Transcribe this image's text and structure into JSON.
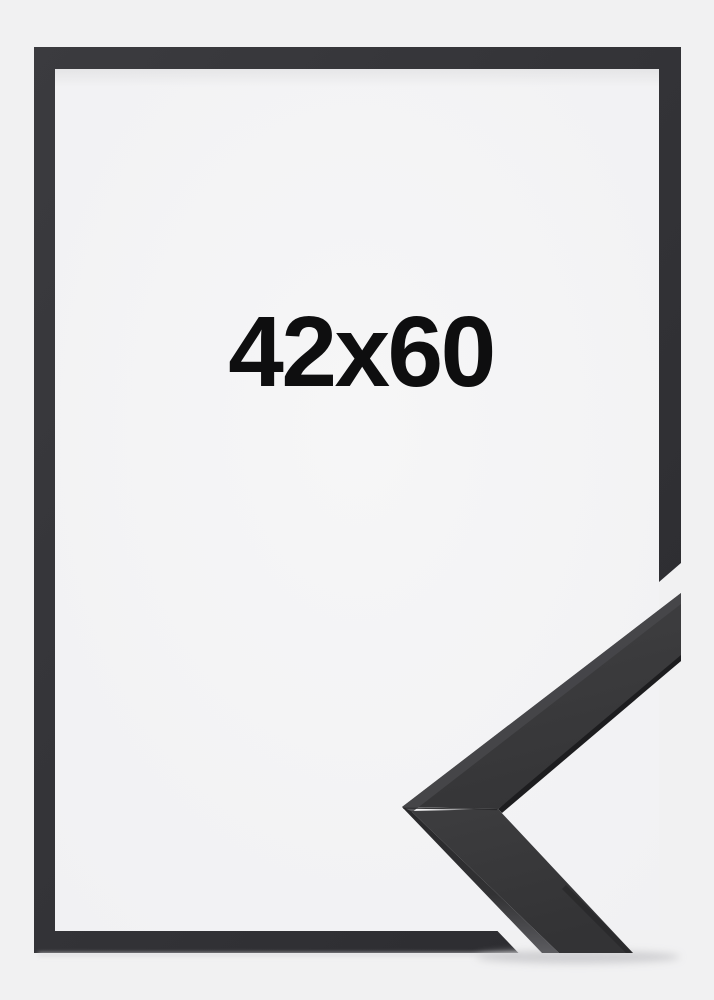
{
  "product": {
    "size_label": "42x60"
  },
  "colors": {
    "background": "#f1f1f2",
    "opening": "#f4f4f5",
    "label_text": "#0e0e0f",
    "frame_light": "#3a3a3e",
    "frame_dark": "#2b2b2f",
    "moulding_face": "#3a3a3c",
    "moulding_face_dark": "#343436",
    "moulding_bevel_highlight": "#47474a",
    "moulding_edge": "#1d1d1f",
    "moulding_side_top": "#28282a",
    "moulding_side_bottom": "#5c5c60",
    "shadow": "#c9c9cc"
  }
}
